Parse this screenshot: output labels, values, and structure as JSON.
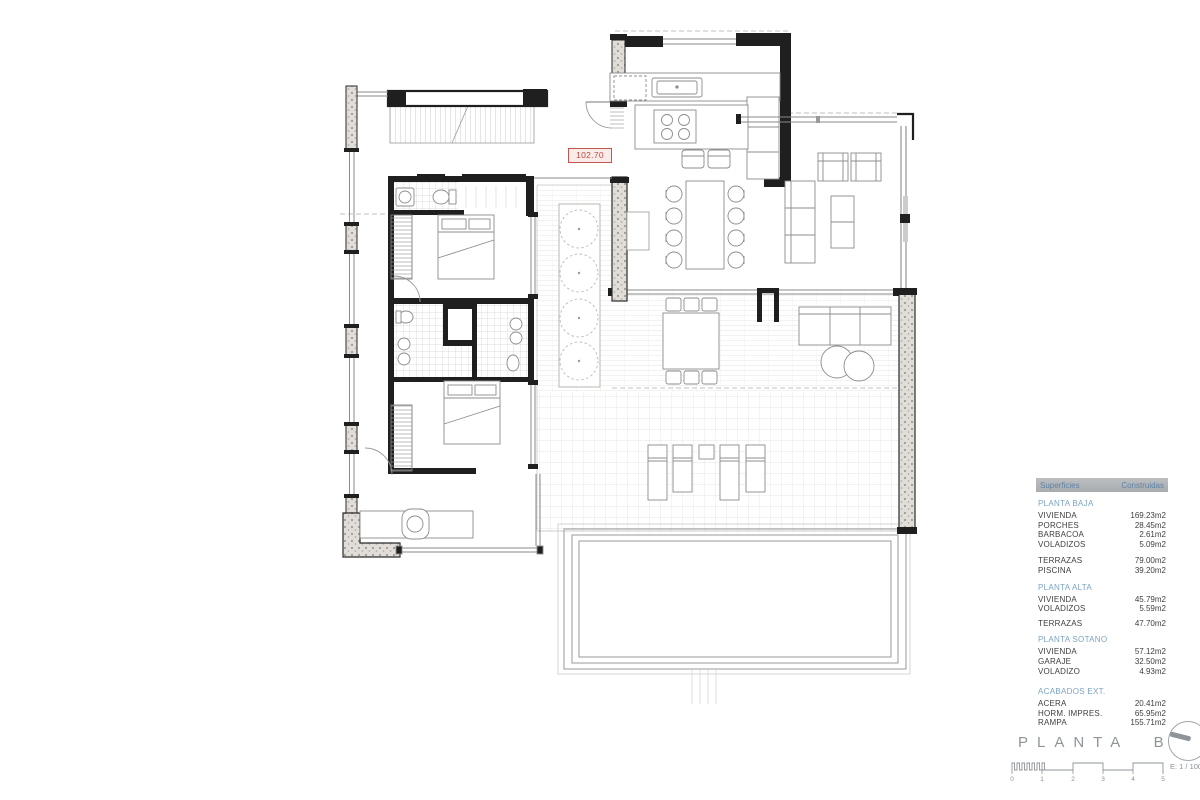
{
  "plan": {
    "level_label": "102.70"
  },
  "areas_table": {
    "header": {
      "col1": "Superficies",
      "col2": "Construidas"
    },
    "sections": [
      {
        "title": "PLANTA BAJA",
        "rows": [
          {
            "label": "VIVIENDA",
            "value": "169.23m2"
          },
          {
            "label": "PORCHES",
            "value": "28.45m2"
          },
          {
            "label": "BARBACOA",
            "value": "2.61m2"
          },
          {
            "label": "VOLADIZOS",
            "value": "5.09m2"
          }
        ]
      },
      {
        "title": "",
        "rows": [
          {
            "label": "TERRAZAS",
            "value": "79.00m2"
          },
          {
            "label": "PISCINA",
            "value": "39.20m2"
          }
        ]
      },
      {
        "title": "PLANTA ALTA",
        "rows": [
          {
            "label": "VIVIENDA",
            "value": "45.79m2"
          },
          {
            "label": "VOLADIZOS",
            "value": "5.59m2"
          }
        ]
      },
      {
        "title": "",
        "rows": [
          {
            "label": "TERRAZAS",
            "value": "47.70m2"
          }
        ]
      },
      {
        "title": "PLANTA SOTANO",
        "rows": [
          {
            "label": "VIVIENDA",
            "value": "57.12m2"
          },
          {
            "label": "GARAJE",
            "value": "32.50m2"
          },
          {
            "label": "VOLADIZO",
            "value": "4.93m2"
          }
        ]
      },
      {
        "title": "ACABADOS EXT.",
        "rows": [
          {
            "label": "ACERA",
            "value": "20.41m2"
          },
          {
            "label": "HORM. IMPRES.",
            "value": "65.95m2"
          },
          {
            "label": "RAMPA",
            "value": "155.71m2"
          }
        ]
      }
    ]
  },
  "titleblock": {
    "title": "PLANTA BAJA",
    "scale_label": "E: 1 / 100",
    "scale_ticks": [
      "0",
      "1",
      "2",
      "3",
      "4",
      "5"
    ]
  },
  "colors": {
    "accent_red": "#c4564e",
    "heading_blue": "#7ba3c2",
    "table_header_bg": "#b2b5b8",
    "wall_black": "#1f1f1f"
  }
}
